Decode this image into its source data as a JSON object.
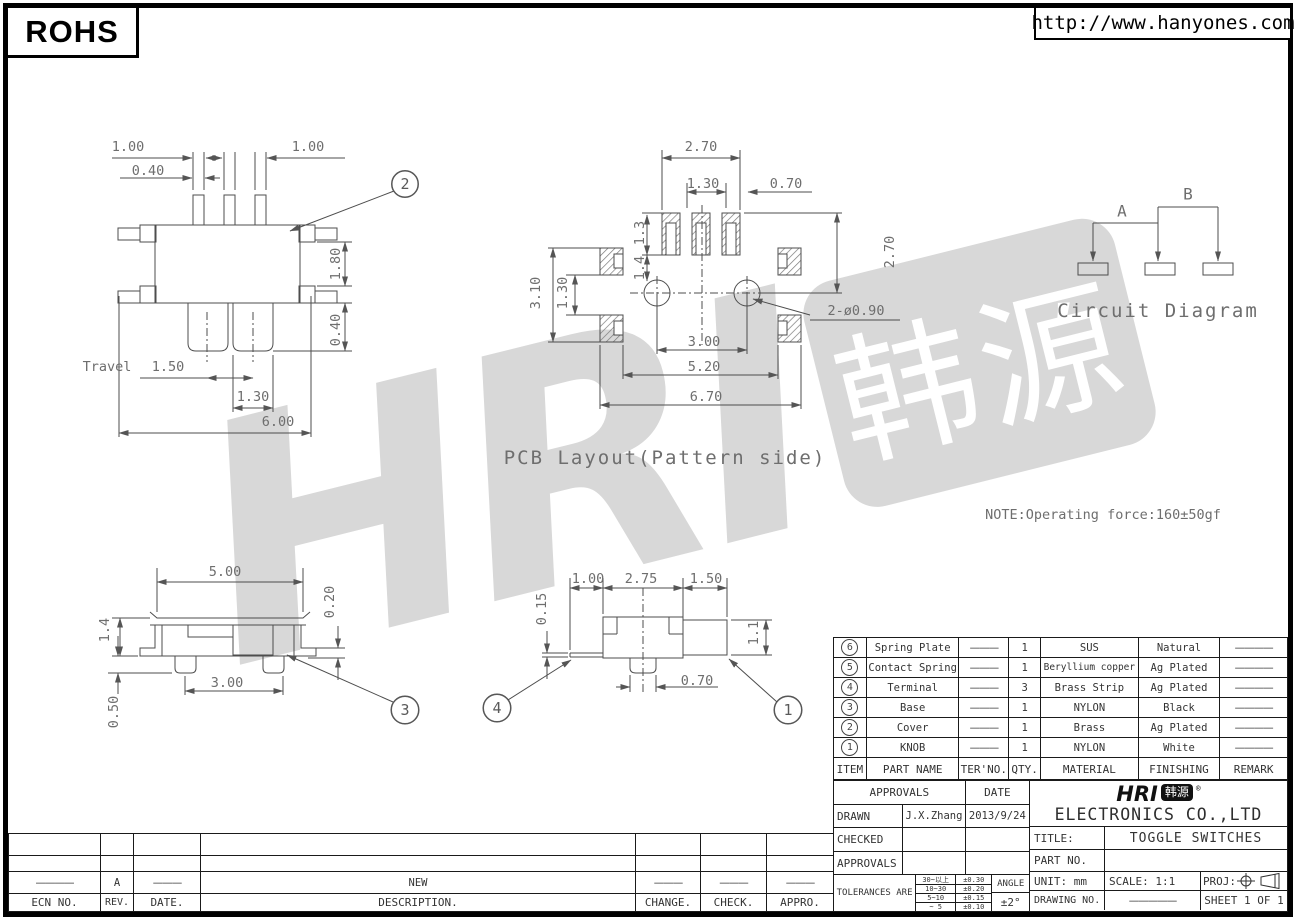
{
  "header": {
    "rohs": "ROHS",
    "url": "http://www.hanyones.com"
  },
  "watermark": {
    "text": "HRI",
    "box_text": "韩源"
  },
  "views": {
    "top": {
      "callout": "2",
      "pitch_left": "1.00",
      "pitch_right": "1.00",
      "pin_width": "0.40",
      "body_height": "1.80",
      "ear_offset": "0.40",
      "travel_label": "Travel",
      "travel": "1.50",
      "knob_width": "1.30",
      "body_width": "6.00"
    },
    "pcb": {
      "title": "PCB Layout(Pattern side)",
      "pad_span": "2.70",
      "pad_pitch": "1.30",
      "pad_offset": "0.70",
      "pad_height": "1.3",
      "hole_offset": "1.4",
      "side_span": "3.10",
      "side_gap": "1.30",
      "col_height": "2.70",
      "hole_pitch": "3.00",
      "inner_span": "5.20",
      "outer_span": "6.70",
      "holes": "2-ø0.90"
    },
    "circuit": {
      "a": "A",
      "b": "B",
      "title": "Circuit Diagram"
    },
    "note": "NOTE:Operating force:160±50gf",
    "side": {
      "callout": "3",
      "width": "5.00",
      "clearance": "0.20",
      "height": "1.4",
      "pin_pitch": "3.00",
      "pin_height": "0.50"
    },
    "front": {
      "callout_knob": "1",
      "callout_plate": "4",
      "seg_left": "1.00",
      "seg_mid": "2.75",
      "seg_right": "1.50",
      "plate_thickness": "0.15",
      "knob_height": "1.1",
      "pin_width": "0.70"
    }
  },
  "parts_table": {
    "headers": [
      "ITEM",
      "PART NAME",
      "TER'NO.",
      "QTY.",
      "MATERIAL",
      "FINISHING",
      "REMARK"
    ],
    "rows": [
      {
        "item": "6",
        "name": "Spring Plate",
        "ter": "———",
        "qty": "1",
        "material": "SUS",
        "finish": "Natural",
        "remark": "————"
      },
      {
        "item": "5",
        "name": "Contact Spring",
        "ter": "———",
        "qty": "1",
        "material": "Beryllium copper",
        "finish": "Ag Plated",
        "remark": "————"
      },
      {
        "item": "4",
        "name": "Terminal",
        "ter": "———",
        "qty": "3",
        "material": "Brass Strip",
        "finish": "Ag Plated",
        "remark": "————"
      },
      {
        "item": "3",
        "name": "Base",
        "ter": "———",
        "qty": "1",
        "material": "NYLON",
        "finish": "Black",
        "remark": "————"
      },
      {
        "item": "2",
        "name": "Cover",
        "ter": "———",
        "qty": "1",
        "material": "Brass",
        "finish": "Ag Plated",
        "remark": "————"
      },
      {
        "item": "1",
        "name": "KNOB",
        "ter": "———",
        "qty": "1",
        "material": "NYLON",
        "finish": "White",
        "remark": "————"
      }
    ]
  },
  "title_block": {
    "approvals_label": "APPROVALS",
    "date_label": "DATE",
    "drawn_label": "DRAWN",
    "drawn_by": "J.X.Zhang",
    "drawn_date": "2013/9/24",
    "checked_label": "CHECKED",
    "approvals2_label": "APPROVALS",
    "tolerances_label": "TOLERANCES ARE",
    "tolerances": [
      {
        "range": "30~以上",
        "value": "±0.30"
      },
      {
        "range": "10~30",
        "value": "±0.20"
      },
      {
        "range": "5~10",
        "value": "±0.15"
      },
      {
        "range": "~ 5",
        "value": "±0.10"
      }
    ],
    "angle_label": "ANGLE",
    "angle_value": "±2°",
    "logo_text": "HRI",
    "logo_cn": "韩源",
    "logo_reg": "®",
    "company": "ELECTRONICS CO.,LTD",
    "title_label": "TITLE:",
    "title_value": "TOGGLE SWITCHES",
    "part_no_label": "PART NO.",
    "unit": "UNIT: mm",
    "scale": "SCALE: 1:1",
    "proj_label": "PROJ:",
    "drawing_no_label": "DRAWING NO.",
    "drawing_no_value": "—————",
    "sheet": "SHEET 1 OF 1"
  },
  "revision_table": {
    "headers": [
      "ECN NO.",
      "REV.",
      "DATE.",
      "DESCRIPTION.",
      "CHANGE.",
      "CHECK.",
      "APPRO."
    ],
    "rows": [
      {
        "ecn": "————",
        "rev": "A",
        "date": "———",
        "description": "NEW",
        "change": "———",
        "check": "———",
        "appro": "———"
      }
    ]
  }
}
